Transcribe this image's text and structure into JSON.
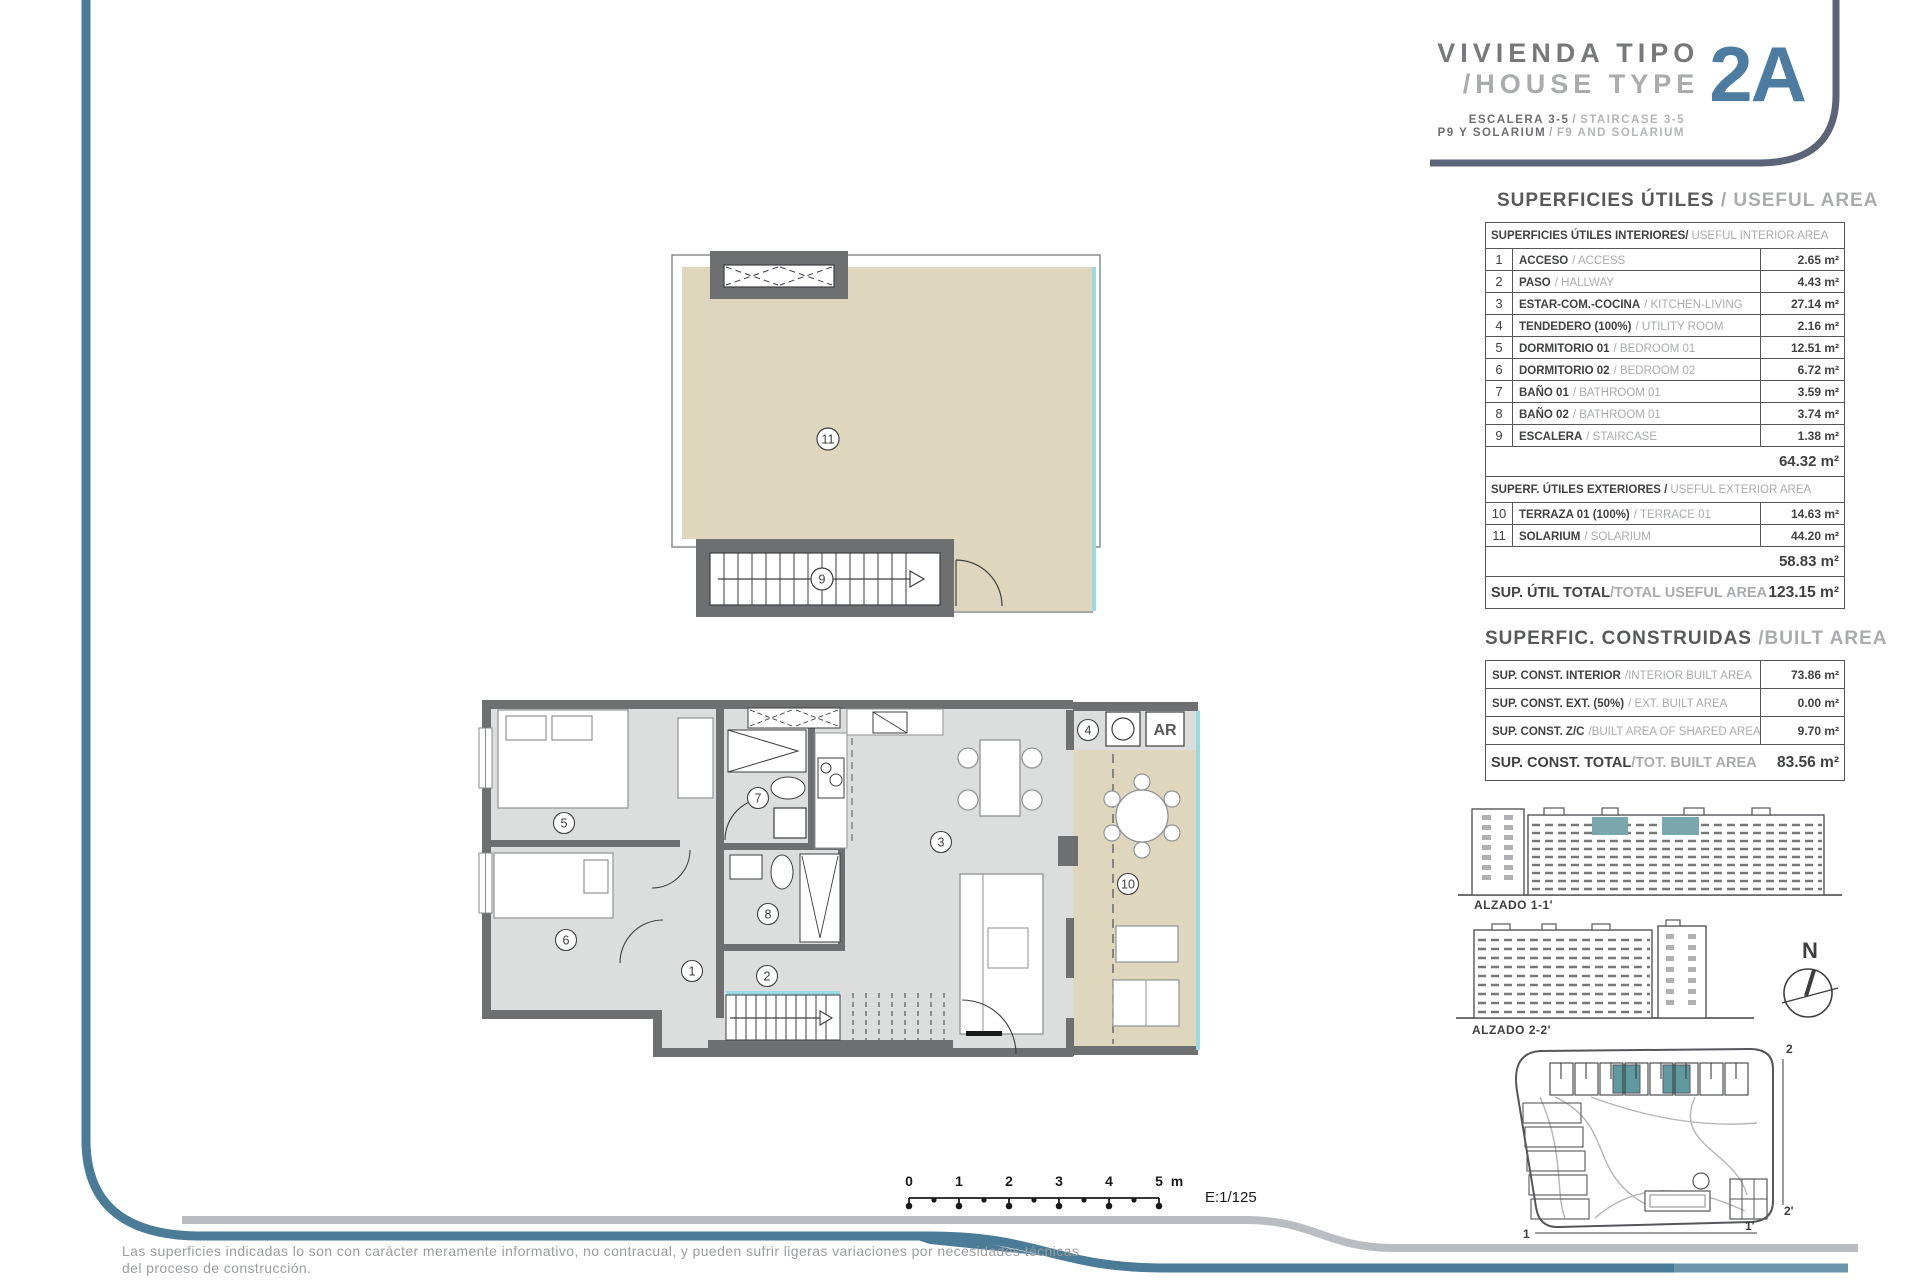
{
  "header": {
    "title_es": "VIVIENDA TIPO",
    "title_en": "/HOUSE TYPE",
    "type_code": "2A",
    "sep": "/",
    "sub1_es": "ESCALERA 3-5",
    "sub1_en": "STAIRCASE 3-5",
    "sub2_es": "P9  Y SOLARIUM",
    "sub2_en": "F9 AND SOLARIUM"
  },
  "useful_area": {
    "title_es": "SUPERFICIES ÚTILES",
    "title_en": "/ USEFUL AREA",
    "interior_header_es": "SUPERFICIES ÚTILES INTERIORES/",
    "interior_header_en": "USEFUL INTERIOR AREA",
    "interior_rows": [
      {
        "num": "1",
        "es": "ACCESO",
        "en": "/ ACCESS",
        "value": "2.65 m²"
      },
      {
        "num": "2",
        "es": "PASO",
        "en": "/ HALLWAY",
        "value": "4.43 m²"
      },
      {
        "num": "3",
        "es": "ESTAR-COM.-COCINA",
        "en": "/ KITCHEN-LIVING",
        "value": "27.14 m²"
      },
      {
        "num": "4",
        "es": "TENDEDERO (100%)",
        "en": "/ UTILITY ROOM",
        "value": "2.16 m²"
      },
      {
        "num": "5",
        "es": "DORMITORIO 01",
        "en": "/ BEDROOM 01",
        "value": "12.51 m²"
      },
      {
        "num": "6",
        "es": "DORMITORIO 02",
        "en": "/ BEDROOM 02",
        "value": "6.72 m²"
      },
      {
        "num": "7",
        "es": "BAÑO 01",
        "en": "/ BATHROOM 01",
        "value": "3.59 m²"
      },
      {
        "num": "8",
        "es": "BAÑO 02",
        "en": "/ BATHROOM 01",
        "value": "3.74 m²"
      },
      {
        "num": "9",
        "es": "ESCALERA",
        "en": "/ STAIRCASE",
        "value": "1.38 m²"
      }
    ],
    "interior_subtotal": "64.32 m²",
    "exterior_header_es": "SUPERF. ÚTILES EXTERIORES /",
    "exterior_header_en": "USEFUL EXTERIOR AREA",
    "exterior_rows": [
      {
        "num": "10",
        "es": "TERRAZA 01 (100%)",
        "en": "/ TERRACE 01",
        "value": "14.63 m²"
      },
      {
        "num": "11",
        "es": "SOLARIUM",
        "en": "/ SOLARIUM",
        "value": "44.20 m²"
      }
    ],
    "exterior_subtotal": "58.83 m²",
    "total_label_es": "SUP. ÚTIL TOTAL",
    "total_label_en": "/TOTAL USEFUL AREA",
    "total_value": "123.15 m²"
  },
  "built_area": {
    "title_es": "SUPERFIC. CONSTRUIDAS",
    "title_en": "/BUILT AREA",
    "rows": [
      {
        "es": "SUP. CONST. INTERIOR",
        "en": "/INTERIOR BUILT AREA",
        "value": "73.86 m²"
      },
      {
        "es": "SUP. CONST. EXT. (50%)",
        "en": "/ EXT. BUILT AREA",
        "value": "0.00 m²"
      },
      {
        "es": "SUP. CONST. Z/C",
        "en": "/BUILT AREA OF SHARED AREAS",
        "value": "9.70 m²"
      }
    ],
    "total_label_es": "SUP. CONST. TOTAL",
    "total_label_en": "/TOT. BUILT AREA",
    "total_value": "83.56 m²"
  },
  "floor_plan": {
    "labels": {
      "1": "1",
      "2": "2",
      "3": "3",
      "4": "4",
      "5": "5",
      "6": "6",
      "7": "7",
      "8": "8",
      "9": "9",
      "10": "10",
      "11": "11"
    },
    "ar": "AR"
  },
  "elevations": {
    "alzado_1": "ALZADO 1-1'",
    "alzado_2": "ALZADO 2-2'",
    "compass_n": "N"
  },
  "site_plan": {
    "marker_1": "1",
    "marker_1p": "1'",
    "marker_2": "2",
    "marker_2p": "2'"
  },
  "scale_bar": {
    "ticks": [
      "0",
      "1",
      "2",
      "3",
      "4",
      "5"
    ],
    "unit": "m",
    "ratio": "E:1/125"
  },
  "footer": {
    "line1_es": "Las superficies indicadas lo son con carácter meramente informativo, no contracual, y pueden sufrir ligeras variaciones por necesidades técnicas",
    "line2_es": "del proceso de construcción.",
    "line3_en": "The indicated areas are for information purposes only, not contractual, and may vary slightly by technical requirements of the construction process."
  },
  "colors": {
    "accent_blue": "#4d7ca3",
    "slate_corner_line": "#5c6578",
    "steel_swoosh": "#4a7b97",
    "teal_highlight": "#79a7ad",
    "floor_beige": "#ded7bd",
    "room_gray": "#dcdddd",
    "wall_gray": "#6e6f71",
    "glass_teal": "#9adbe3"
  }
}
